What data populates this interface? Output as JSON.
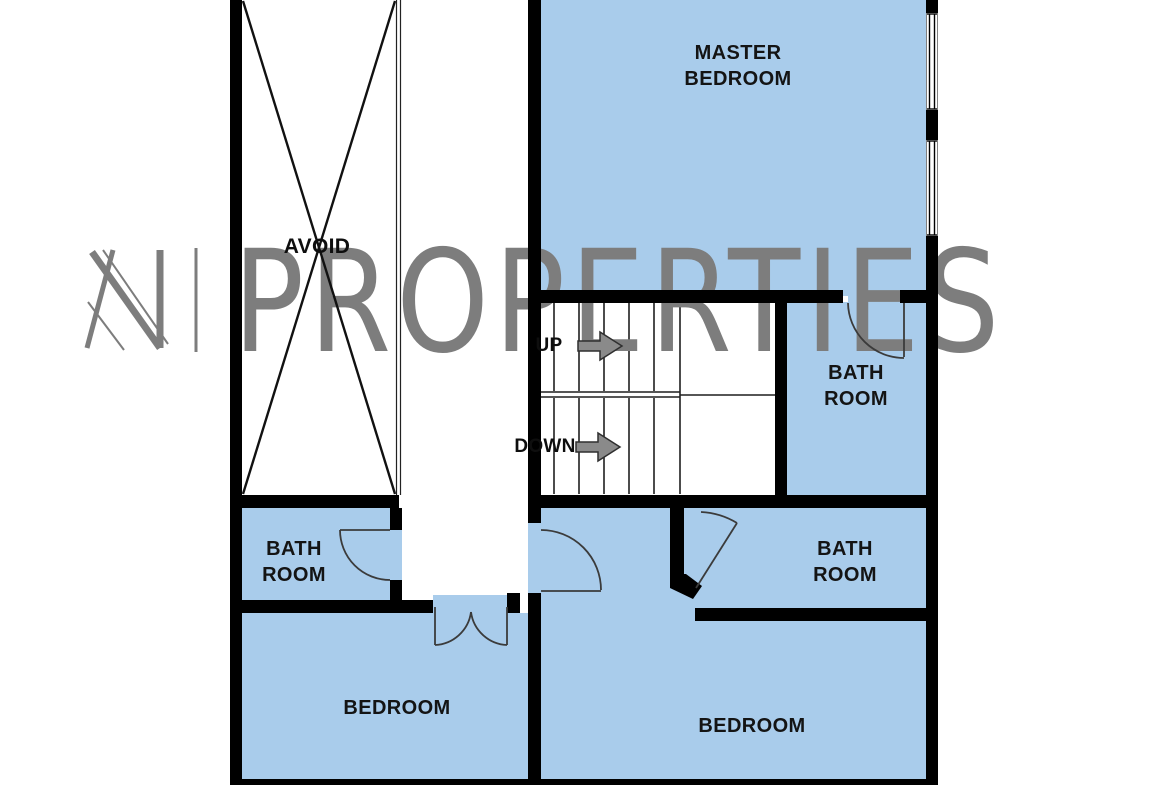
{
  "plan": {
    "title_watermark": {
      "logo_letter": "N",
      "brand": "PROPERTIES"
    },
    "rooms": [
      {
        "id": "master-bedroom",
        "line1": "MASTER",
        "line2": "BEDROOM"
      },
      {
        "id": "bath-ensuite",
        "line1": "BATH",
        "line2": "ROOM"
      },
      {
        "id": "bath-left",
        "line1": "BATH",
        "line2": "ROOM"
      },
      {
        "id": "bath-right",
        "line1": "BATH",
        "line2": "ROOM"
      },
      {
        "id": "bedroom-left",
        "line1": "BEDROOM",
        "line2": ""
      },
      {
        "id": "bedroom-right",
        "line1": "BEDROOM",
        "line2": ""
      }
    ],
    "annotations": {
      "avoid": "AVOID",
      "up": "UP",
      "down": "DOWN"
    },
    "colors": {
      "room_fill": "#a9cceb",
      "wall": "#000000",
      "watermark_gray": "#7d7d7d",
      "arrow_gray": "#8a8a8a"
    }
  }
}
